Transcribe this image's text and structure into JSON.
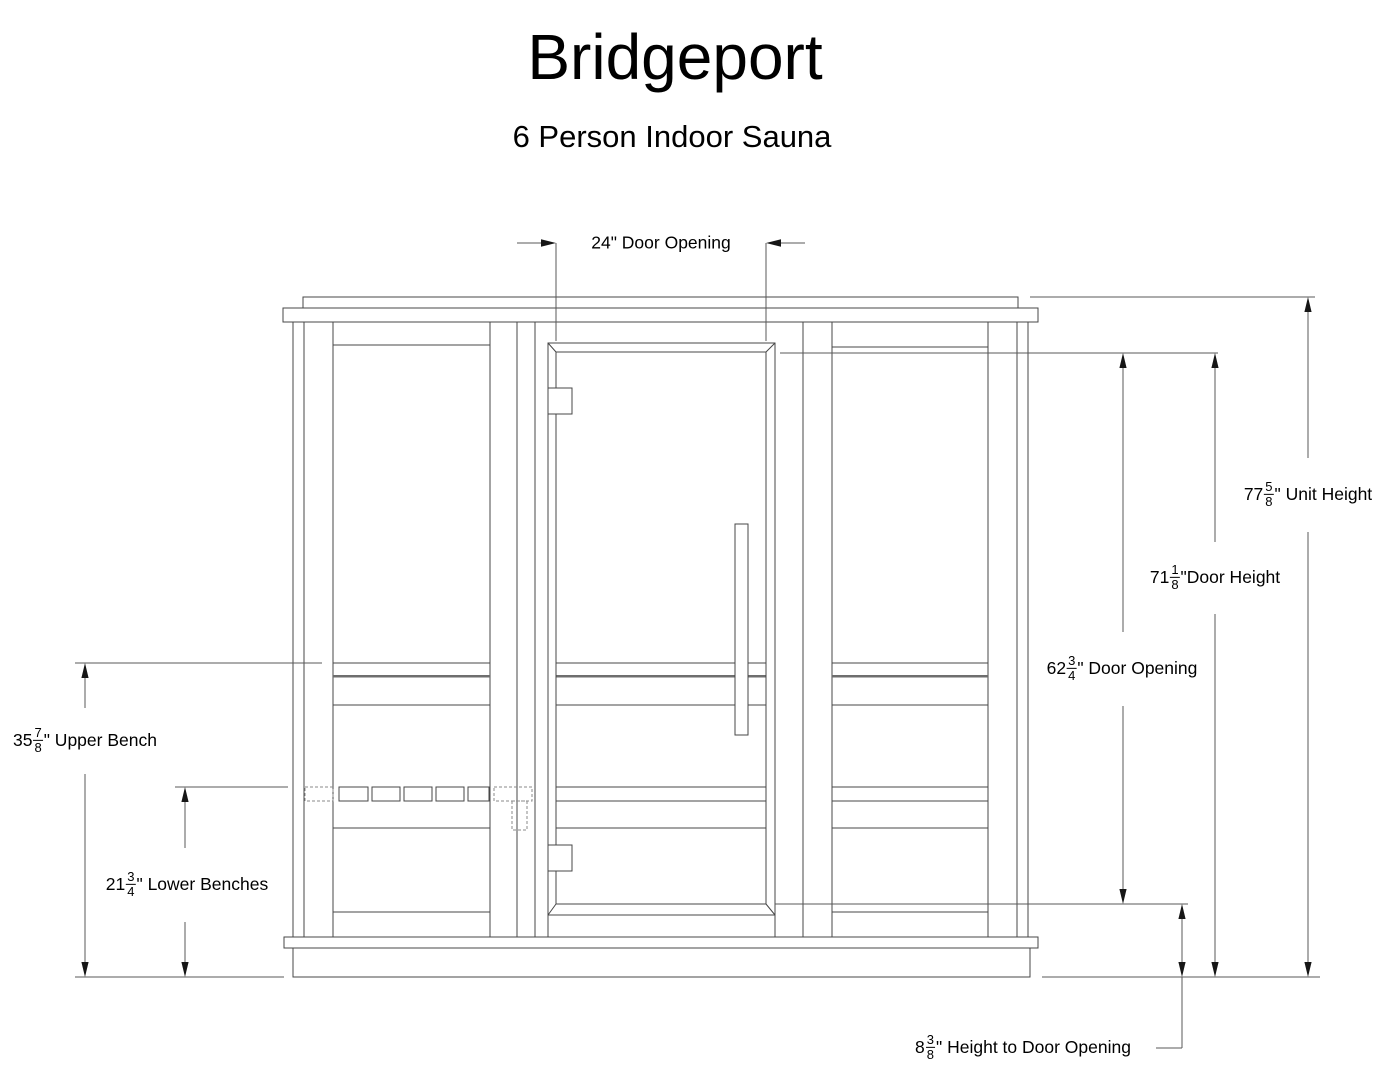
{
  "title": "Bridgeport",
  "subtitle": "6 Person Indoor Sauna",
  "line_color": "#474747",
  "dimensions": {
    "door_opening_width": {
      "text": "24\" Door Opening"
    },
    "unit_height": {
      "whole": "77",
      "num": "5",
      "den": "8",
      "suffix": "\" Unit Height"
    },
    "door_height": {
      "whole": "71",
      "num": "1",
      "den": "8",
      "suffix": "\"Door Height"
    },
    "door_opening_height": {
      "whole": "62",
      "num": "3",
      "den": "4",
      "suffix": "\" Door Opening"
    },
    "upper_bench": {
      "whole": "35",
      "num": "7",
      "den": "8",
      "suffix": "\" Upper Bench"
    },
    "lower_benches": {
      "whole": "21",
      "num": "3",
      "den": "4",
      "suffix": "\" Lower Benches"
    },
    "height_to_door_opening": {
      "whole": "8",
      "num": "3",
      "den": "8",
      "suffix": "\" Height to Door Opening"
    }
  }
}
